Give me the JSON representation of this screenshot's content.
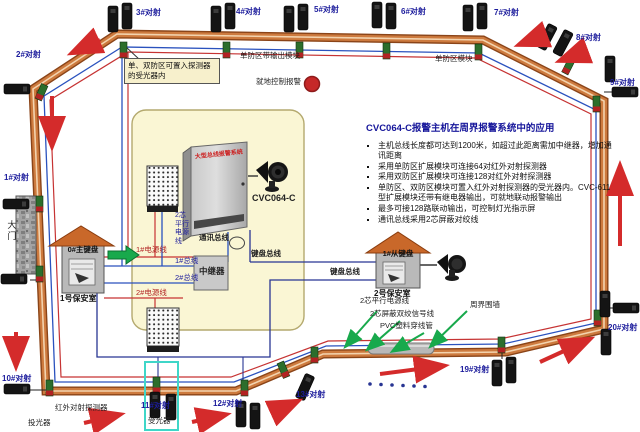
{
  "info": {
    "title": "CVC064-C报警主机在周界报警系统中的应用",
    "bullets": [
      "主机总线长度都可达到1200米，如超过此距离需加中继器，增加通讯距离",
      "采用单防区扩展模块可连接64对红外对射探测器",
      "采用双防区扩展模块可连接128对红外对射探测器",
      "单防区、双防区模块可置入红外对射探测器的受光器内。CVC-611型扩展模块还带有继电器输出，可就地联动报警输出",
      "最多可接128路联动输出，可控制灯光指示屏",
      "通讯总线采用2芯屏蔽对绞线"
    ]
  },
  "detectors": {
    "d1": "1#对射",
    "d2": "2#对射",
    "d3": "3#对射",
    "d4": "4#对射",
    "d5": "5#对射",
    "d6": "6#对射",
    "d7": "7#对射",
    "d8": "8#对射",
    "d9": "9#对射",
    "d10": "10#对射",
    "d11": "11#对射",
    "d12": "12#对射",
    "d13": "13#对射",
    "d19": "19#对射",
    "d20": "20#对射"
  },
  "top": {
    "callout": "单、双防区可置入探测器的受光器内",
    "single_zone_output": "单防区带输出模块",
    "local_alarm": "就地控制报警",
    "single_zone_module": "单防区模块"
  },
  "center": {
    "cabinet_model": "CVC064-C",
    "cabinet_text": "大型总线报警系统",
    "comm_bus": "通讯总线",
    "kb_bus1": "键盘总线",
    "kb_bus2": "键盘总线",
    "repeater": "中继器",
    "power1": "1#电源线",
    "bus1": "1#总线",
    "bus2": "2#总线",
    "power2": "2#电源线",
    "power_wire_vertical": "2芯平行电源线"
  },
  "house1": {
    "keypad": "0#主键盘",
    "room": "1号保安室"
  },
  "house2": {
    "keypad": "1#从键盘",
    "room": "2号保安室"
  },
  "bottom": {
    "power_wire": "2芯平行电源线",
    "signal_wire": "2芯屏蔽双绞信号线",
    "pvc": "PVC塑料穿线管",
    "wall": "周界围墙",
    "ir_detector": "红外对射探测器",
    "tx": "投光器",
    "rx": "受光器"
  },
  "gate": "大门",
  "colors": {
    "wall": "#cd7a3e",
    "bus_blue": "#2a52be",
    "bus_red": "#c63333",
    "bus_navy": "#283593",
    "green": "#18a94c",
    "arrow_red": "#d42b2b",
    "highlight_cyan": "#3fd6c8",
    "panel_yellow": "#faf6d4",
    "alarm_red": "#c62828"
  }
}
